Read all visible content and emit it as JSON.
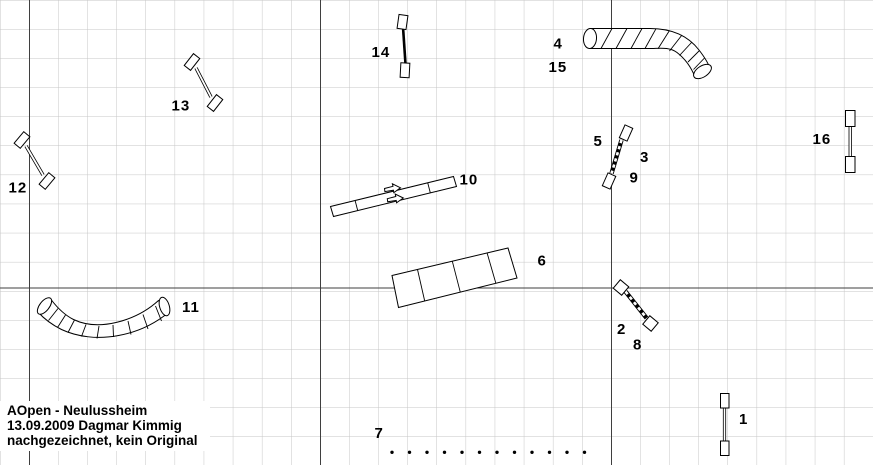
{
  "diagram": {
    "kind": "dog-agility-course-plan",
    "footer": {
      "line1": "AOpen - Neulussheim",
      "line2": "13.09.2009 Dagmar Kimmig",
      "line3": "nachgezeichnet, kein Original"
    },
    "colors": {
      "background": "#ffffff",
      "grid_minor": "#c6c6c6",
      "grid_major": "#3f3f3f",
      "ink": "#000000"
    },
    "grid": {
      "cell_px": 29.1,
      "major_vertical_x": [
        29.5,
        320.5,
        611.5
      ],
      "major_horizontal_y": [
        288
      ]
    },
    "weave_poles": {
      "count": 12
    },
    "obstacles": [
      {
        "kind": "jump",
        "numbers": [
          "1"
        ]
      },
      {
        "kind": "jump",
        "numbers": [
          "2",
          "8"
        ]
      },
      {
        "kind": "jump",
        "numbers": [
          "5",
          "3",
          "9"
        ]
      },
      {
        "kind": "curved-tunnel",
        "numbers": [
          "4",
          "15"
        ]
      },
      {
        "kind": "segmented-box",
        "numbers": [
          "6"
        ]
      },
      {
        "kind": "weave-poles",
        "numbers": [
          "7"
        ]
      },
      {
        "kind": "plank-walk",
        "numbers": [
          "10"
        ]
      },
      {
        "kind": "curved-tunnel",
        "numbers": [
          "11"
        ]
      },
      {
        "kind": "jump",
        "numbers": [
          "12"
        ]
      },
      {
        "kind": "jump",
        "numbers": [
          "13"
        ]
      },
      {
        "kind": "jump",
        "numbers": [
          "14"
        ]
      },
      {
        "kind": "jump",
        "numbers": [
          "16"
        ]
      }
    ],
    "labels": [
      {
        "text": "1"
      },
      {
        "text": "2"
      },
      {
        "text": "8"
      },
      {
        "text": "5"
      },
      {
        "text": "3"
      },
      {
        "text": "9"
      },
      {
        "text": "4"
      },
      {
        "text": "15"
      },
      {
        "text": "6"
      },
      {
        "text": "7"
      },
      {
        "text": "10"
      },
      {
        "text": "11"
      },
      {
        "text": "12"
      },
      {
        "text": "13"
      },
      {
        "text": "14"
      },
      {
        "text": "16"
      }
    ]
  }
}
